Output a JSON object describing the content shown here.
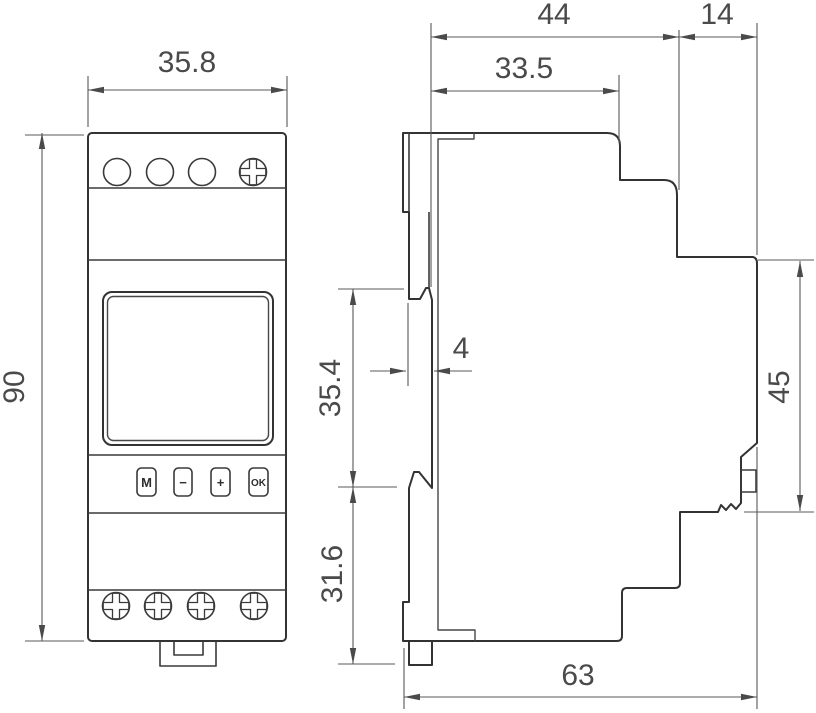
{
  "drawing": {
    "description": "DIN-rail timer device dimensional drawing, front and side views",
    "colors": {
      "outline": "#333333",
      "dimension_lines": "#585858",
      "dimension_text": "#4a4a4a",
      "background": "#ffffff"
    },
    "front_view": {
      "dims": {
        "width": "35.8",
        "height": "90"
      },
      "buttons": [
        {
          "label": "M"
        },
        {
          "label": "−"
        },
        {
          "label": "+"
        },
        {
          "label": "OK"
        }
      ],
      "top_holes_count": "3",
      "top_screws_count": "1",
      "bottom_screws_count": "4"
    },
    "side_view": {
      "dims": {
        "top_total_width": "44",
        "top_body_width": "33.5",
        "front_cap_width": "14",
        "clip_depth": "4",
        "front_section_height": "45",
        "rail_recess_height": "35.4",
        "lower_section_height": "31.6",
        "total_depth": "63"
      }
    }
  }
}
